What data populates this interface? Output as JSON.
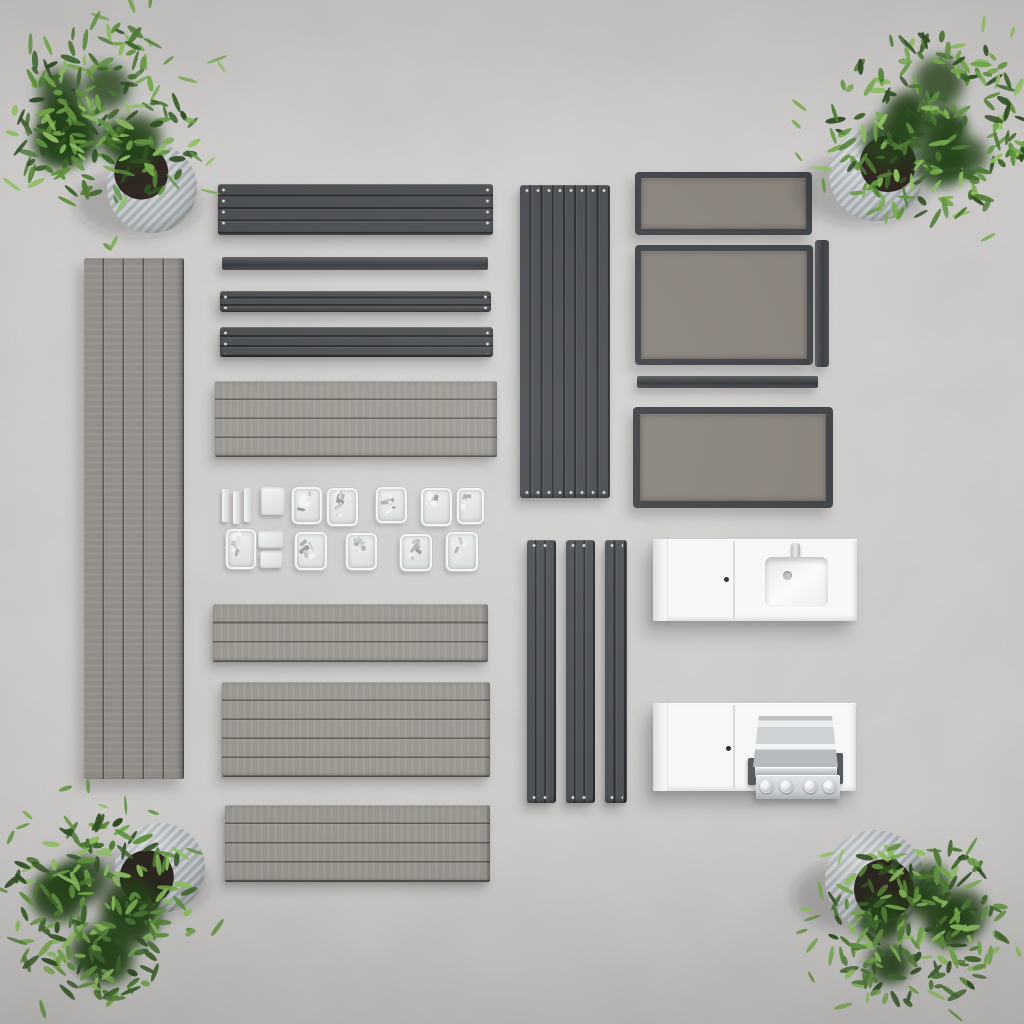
{
  "image": {
    "title": "Flat lay of a modular outdoor kitchen kit",
    "caption": "Top-down view of disassembled outdoor kitchen parts arranged on a concrete floor with a potted plant in each corner"
  },
  "palette": {
    "concrete": "#c9c8c6",
    "charcoal": "#46494c",
    "charcoal_deep": "#393c3f",
    "slat_line": "#17191b",
    "wood_gray": "#99958f",
    "wood_gray_cool": "#918d88",
    "frame": "#3b3e42",
    "frame_fill": "#857f78",
    "post": "#4a4d50",
    "white_module": "#f6f7f8",
    "steel": "#d3d6d8",
    "pot_light": "#c7cbcd",
    "pot_dark": "#a6acb0",
    "soil": "#2b241e",
    "plant_greens": [
      "#2f4d22",
      "#3c6429",
      "#4e7a33",
      "#5f923d",
      "#74a94a",
      "#8cbf5e"
    ]
  },
  "parts": {
    "beam_large": "aluminium frame beam",
    "rail_thin": "slim mounting rail",
    "beam_medium": "aluminium frame beam",
    "beam_wide": "aluminium frame beam",
    "deck_board": "composite deck board",
    "deck_panel_tall": "composite deck panel",
    "slat_panel": "vertical slat back panel",
    "leg": "support leg",
    "framed_panel": "framed slat side panel",
    "side_bar": "side rail",
    "sink_module": "sink cabinet module",
    "grill_module": "grill cabinet module",
    "hardware_tray": "hardware tray",
    "plant": "potted plant"
  },
  "plants": [
    {
      "position": "top-left"
    },
    {
      "position": "top-right"
    },
    {
      "position": "bottom-left"
    },
    {
      "position": "bottom-right"
    }
  ]
}
